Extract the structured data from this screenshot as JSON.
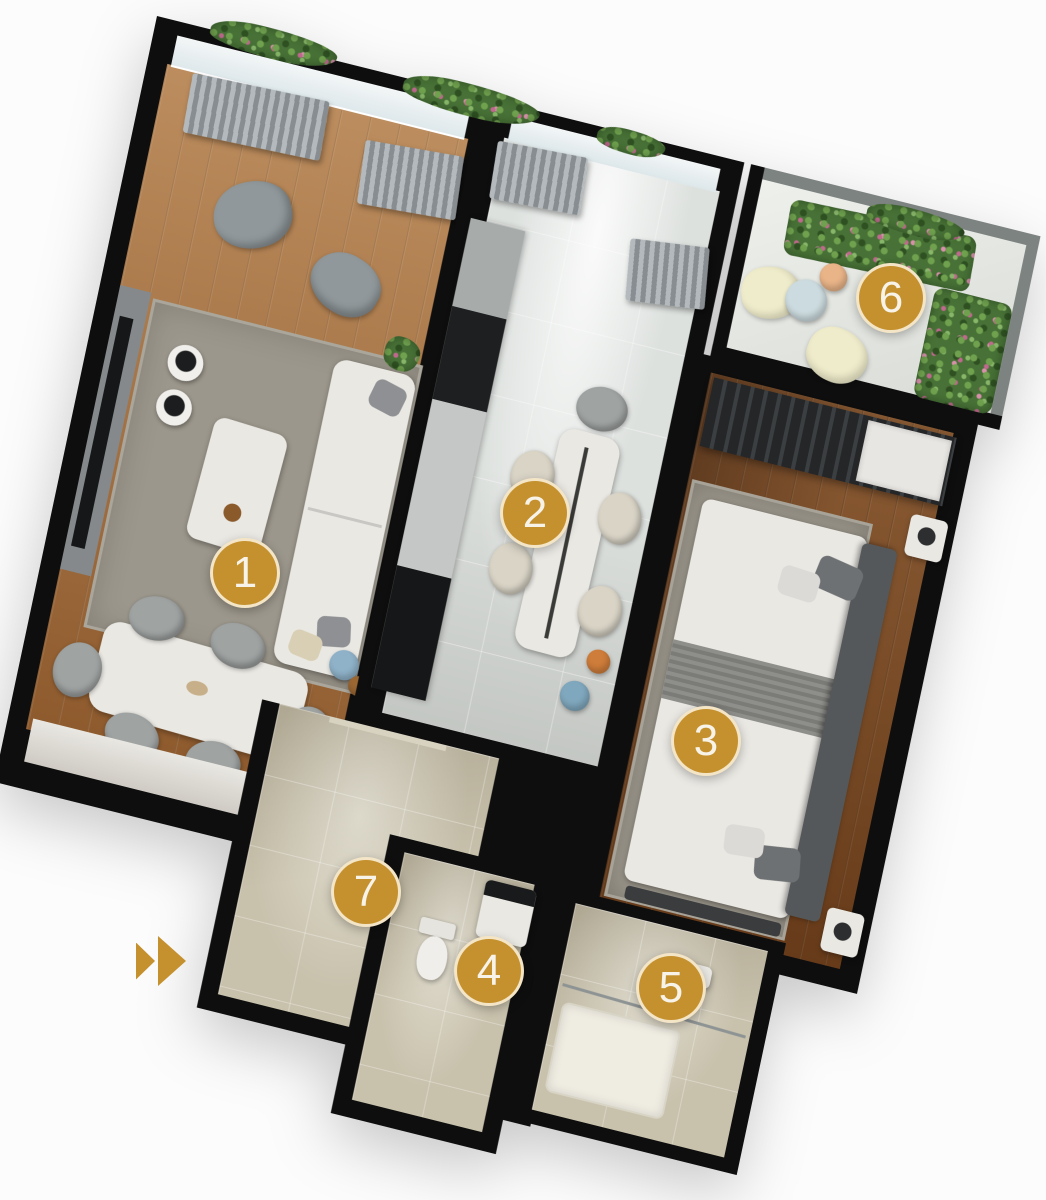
{
  "floorplan": {
    "markers": [
      {
        "label": "1",
        "x": 242,
        "y": 570
      },
      {
        "label": "2",
        "x": 532,
        "y": 510
      },
      {
        "label": "3",
        "x": 703,
        "y": 738
      },
      {
        "label": "4",
        "x": 486,
        "y": 968
      },
      {
        "label": "5",
        "x": 668,
        "y": 985
      },
      {
        "label": "6",
        "x": 888,
        "y": 295
      },
      {
        "label": "7",
        "x": 363,
        "y": 889
      }
    ],
    "marker_style": {
      "fill": "#c5912e",
      "ring": "rgba(250,243,225,0.85)",
      "text": "#f7f3e8"
    },
    "direction_indicator": {
      "icon": "fast-forward-icon",
      "color": "#c5912e",
      "x": 136,
      "y": 936
    },
    "palette": {
      "wall": "#0e0e0e",
      "wood-light": "#a9713c",
      "wood-dark": "#7c4a22",
      "tile-warm": "#c8c1ac",
      "tile-cool": "#dde1de",
      "rug": "#9c978c",
      "plant-green": "#477136",
      "plant-flower": "#c0688e",
      "curtain": "#9aa0a3"
    }
  }
}
